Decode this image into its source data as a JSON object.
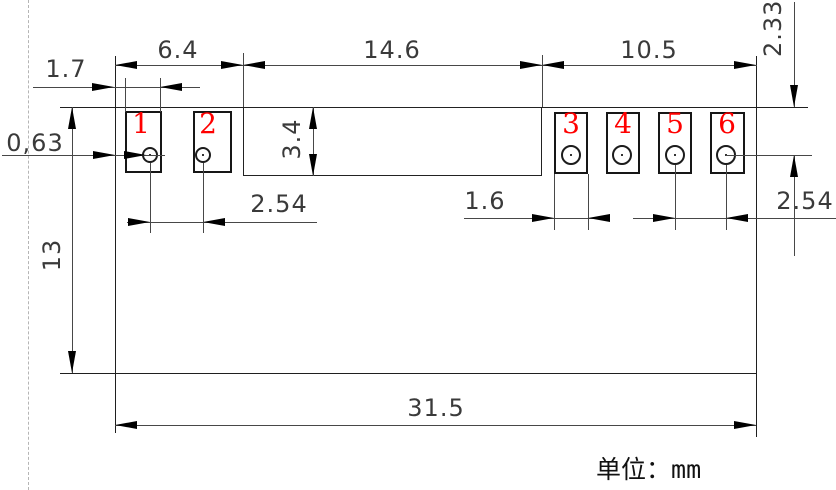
{
  "drawing": {
    "type": "component-footprint-dimension-drawing",
    "unit_prefix": "单位：",
    "unit_value": "mm",
    "pins": [
      "1",
      "2",
      "3",
      "4",
      "5",
      "6"
    ],
    "dims": {
      "left_group_width": "6.4",
      "center_width": "14.6",
      "right_group_width": "10.5",
      "pad1_width": "1.7",
      "hole_offset": "0,63",
      "body_height": "13",
      "center_depth": "3.4",
      "left_pitch": "2.54",
      "pad3_width": "1.6",
      "right_pitch": "2.54",
      "edge_to_hole": "2.33",
      "total_width": "31.5"
    },
    "colors": {
      "pin_number": "#ff0000",
      "outline": "#1f1f1f",
      "dimension_line": "#474747",
      "arrow": "#000000",
      "centerline_dashed": "#b5b5b5"
    }
  }
}
